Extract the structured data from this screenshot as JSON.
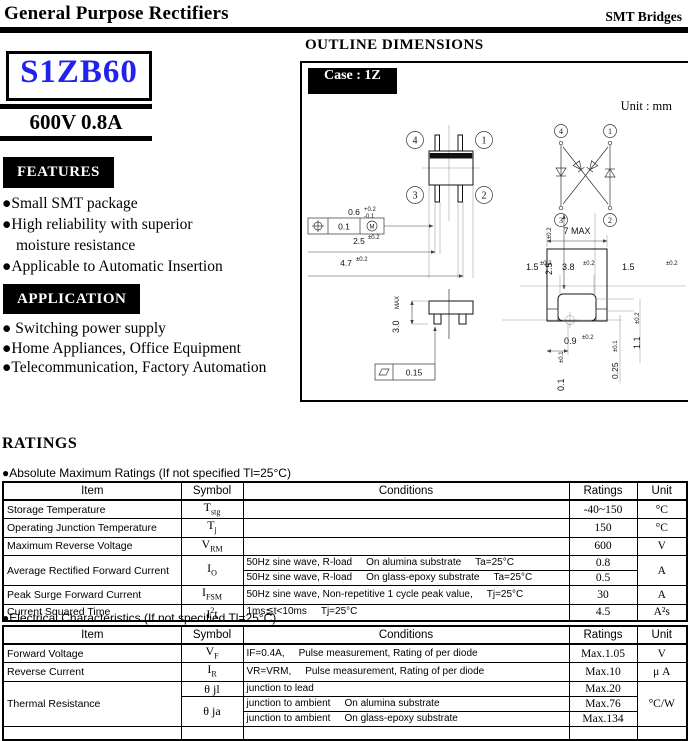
{
  "theme": {
    "part-color": "#2222ee"
  },
  "header": {
    "title": "General Purpose Rectifiers",
    "category": "SMT Bridges"
  },
  "product": {
    "part_number": "S1ZB60",
    "rating_line": "600V 0.8A"
  },
  "features": {
    "title": "FEATURES",
    "items": [
      "●Small SMT package",
      "●High reliability with superior moisture resistance",
      "●Applicable to Automatic Insertion"
    ]
  },
  "application": {
    "title": "APPLICATION",
    "items": [
      "● Switching power supply",
      "●Home Appliances, Office Equipment",
      "●Telecommunication, Factory Automation"
    ]
  },
  "outline": {
    "title": "OUTLINE DIMENSIONS",
    "case_label": "Case : 1Z",
    "unit_label": "Unit : mm",
    "pins": {
      "p1": "1",
      "p2": "2",
      "p3": "3",
      "p4": "4"
    },
    "dims": {
      "tol_val": "0.1",
      "tol_mod": "M",
      "d06": "0.6",
      "d06_sup": "+0.2",
      "d06_sub": "-0.1",
      "d25": "2.5",
      "d25_tol": "±0.2",
      "d47": "4.7",
      "d47_tol": "±0.2",
      "d25v": "2.5",
      "d25v_tol": "±0.2",
      "d30": "3.0",
      "d30_suf": "MAX",
      "flat_val": "0.15",
      "d01": "0.1",
      "d01_tol": "±0.1",
      "d7": "7 MAX",
      "d15l": "1.5",
      "d15l_tol": "±0.2",
      "d38": "3.8",
      "d38_tol": "±0.2",
      "d15r": "1.5",
      "d15r_tol": "±0.2",
      "d09": "0.9",
      "d09_tol": "±0.2",
      "d025": "0.25",
      "d025_tol": "±0.1",
      "d11": "1.1",
      "d11_tol": "±0.2"
    }
  },
  "ratings": {
    "title": "RATINGS",
    "abs_max": {
      "label": "●Absolute Maximum Ratings (If not specified Tl=25°C)",
      "headers": [
        "Item",
        "Symbol",
        "Conditions",
        "Ratings",
        "Unit"
      ],
      "rows": [
        {
          "item": "Storage Temperature",
          "sym": "T",
          "sym_sub": "stg",
          "rating": "-40~150",
          "unit": "°C"
        },
        {
          "item": "Operating Junction Temperature",
          "sym": "T",
          "sym_sub": "j",
          "rating": "150",
          "unit": "°C"
        },
        {
          "item": "Maximum Reverse Voltage",
          "sym": "V",
          "sym_sub": "RM",
          "rating": "600",
          "unit": "V"
        },
        {
          "item": "Average Rectified Forward Current",
          "sym": "I",
          "sym_sub": "O",
          "cond": [
            "50Hz sine wave, R-load",
            "On alumina substrate",
            "Ta=25°C"
          ],
          "rating": "0.8",
          "unit": "A"
        },
        {
          "cond": [
            "50Hz sine wave, R-load",
            "On glass-epoxy substrate",
            "Ta=25°C"
          ],
          "rating": "0.5"
        },
        {
          "item": "Peak Surge Forward Current",
          "sym": "I",
          "sym_sub": "FSM",
          "cond": [
            "50Hz sine wave, Non-repetitive 1 cycle peak value,",
            "Tj=25°C"
          ],
          "rating": "30",
          "unit": "A"
        },
        {
          "item": "Current Squared Time",
          "sym": "I",
          "sym_sup": "2",
          "sym_post": "t",
          "cond": [
            "1ms≦t<10ms",
            "Tj=25°C"
          ],
          "rating": "4.5",
          "unit": "A²s"
        }
      ]
    },
    "elec": {
      "label": "●Electrical Characteristics (If not specified Tl=25°C)",
      "headers": [
        "Item",
        "Symbol",
        "Conditions",
        "Ratings",
        "Unit"
      ],
      "rows": [
        {
          "item": "Forward Voltage",
          "sym": "V",
          "sym_sub": "F",
          "cond": [
            "IF=0.4A,",
            "Pulse measurement, Rating of per diode"
          ],
          "rating": "Max.1.05",
          "unit": "V"
        },
        {
          "item": "Reverse Current",
          "sym": "I",
          "sym_sub": "R",
          "cond": [
            "VR=VRM,",
            "Pulse measurement, Rating of per diode"
          ],
          "rating": "Max.10",
          "unit": "μ A"
        },
        {
          "item": "Thermal Resistance",
          "sym": "θ",
          "sym_post": " jl",
          "cond": [
            "junction to lead"
          ],
          "rating": "Max.20",
          "unit": "°C/W"
        },
        {
          "sym": "θ",
          "sym_post": " ja",
          "cond": [
            "junction to ambient",
            "On alumina substrate"
          ],
          "rating": "Max.76"
        },
        {
          "cond": [
            "junction to ambient",
            "On glass-epoxy substrate"
          ],
          "rating": "Max.134"
        }
      ]
    }
  }
}
